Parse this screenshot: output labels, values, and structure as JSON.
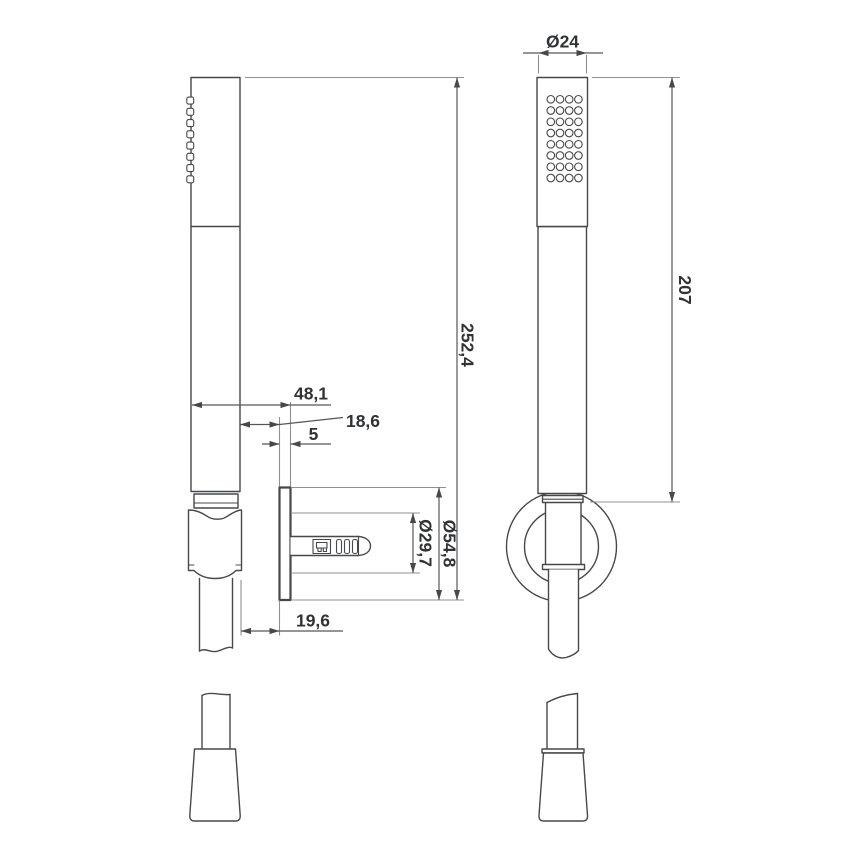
{
  "drawing": {
    "type": "technical-dimension-drawing",
    "subject": "hand shower set with wall holder",
    "colors": {
      "background": "#ffffff",
      "outline": "#47484a",
      "extension_line": "#8f9194",
      "dimension_text": "#303234"
    },
    "dimensions": {
      "head_diameter": "Ø24",
      "head_length": "207",
      "total_length": "252,4",
      "wall_to_front": "48,1",
      "handle_wall_gap": "18,6",
      "plate_thickness": "5",
      "hose_wall_gap": "19,6",
      "hole_diameter": "Ø29,7",
      "plate_diameter": "Ø54,8"
    }
  }
}
